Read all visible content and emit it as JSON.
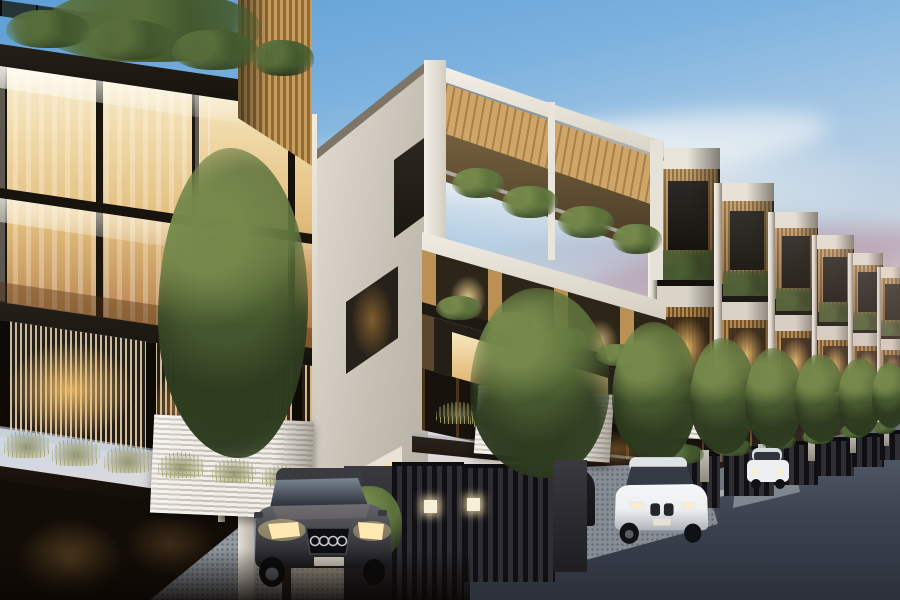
{
  "scene": {
    "type": "architectural-rendering",
    "description": "Dusk exterior rendering of a terrace of modern four-storey townhouses: a dark timber-and-glass corner residence on the left with warm lit interiors, a white townhouse with rooftop pergola in the centre, and identical units receding down the street to the right; gated driveways with parked cars, ornamental trees and balcony planting front a dark asphalt road under a blue-to-sunset sky",
    "time_of_day": "dusk",
    "colors": {
      "sky_top_blue": "#5e9ed4",
      "sky_mid_blue": "#a9c9e4",
      "sky_pale": "#ded9dc",
      "sky_warm": "#ecd7c6",
      "sunset_orange": "#ef8a3c",
      "cloud_mauve": "#a77f92",
      "facade_dark": "#1c1712",
      "facade_white": "#e9e4da",
      "facade_white_shade": "#c9c2b8",
      "wood_warm": "#c49a5e",
      "wood_deep": "#9c7437",
      "window_glow_bright": "#f7ecd2",
      "window_glow_amber": "#e9c27c",
      "window_glow_deep": "#c08b46",
      "glass_cool": "#9fb2bd",
      "foliage_dark": "#2c3a20",
      "foliage_mid": "#4c5e31",
      "foliage_light": "#6d7f44",
      "road_dark": "#303641",
      "road_mid": "#49515e",
      "curb_light": "#9aa0a6",
      "driveway_concrete": "#8d939b",
      "planter_white": "#efece6",
      "car_dark_body": "#44444a",
      "car_white_body": "#edeff1",
      "headlight_warm": "#ffe9b0"
    },
    "row_units": [
      {
        "x": 648,
        "top": 148,
        "w": 72,
        "bottom": 502
      },
      {
        "x": 714,
        "top": 183,
        "w": 60,
        "bottom": 488
      },
      {
        "x": 768,
        "top": 212,
        "w": 50,
        "bottom": 477
      },
      {
        "x": 812,
        "top": 235,
        "w": 42,
        "bottom": 468
      },
      {
        "x": 848,
        "top": 253,
        "w": 35,
        "bottom": 459
      },
      {
        "x": 877,
        "top": 267,
        "w": 28,
        "bottom": 452
      }
    ],
    "trees": [
      {
        "x": 158,
        "y": 148,
        "w": 150,
        "h": 310,
        "trunk": {
          "x": 218,
          "y1": 300,
          "y2": 522,
          "w": 7,
          "light": true
        }
      },
      {
        "x": 470,
        "y": 288,
        "w": 140,
        "h": 190,
        "trunk": {
          "x": 534,
          "y1": 388,
          "y2": 470,
          "w": 5,
          "light": true
        }
      },
      {
        "x": 612,
        "y": 322,
        "w": 86,
        "h": 140,
        "trunk": {
          "x": 652,
          "y1": 420,
          "y2": 468,
          "w": 4
        }
      },
      {
        "x": 690,
        "y": 338,
        "w": 66,
        "h": 116,
        "trunk": {
          "x": 720,
          "y1": 420,
          "y2": 462,
          "w": 3
        }
      },
      {
        "x": 745,
        "y": 348,
        "w": 58,
        "h": 100,
        "trunk": {
          "x": 772,
          "y1": 420,
          "y2": 456,
          "w": 3
        }
      },
      {
        "x": 795,
        "y": 354,
        "w": 50,
        "h": 88,
        "trunk": {
          "x": 818,
          "y1": 418,
          "y2": 450,
          "w": 2
        }
      },
      {
        "x": 838,
        "y": 358,
        "w": 44,
        "h": 78,
        "trunk": {
          "x": 858,
          "y1": 416,
          "y2": 446,
          "w": 2
        }
      },
      {
        "x": 872,
        "y": 362,
        "w": 36,
        "h": 66,
        "trunk": {
          "x": 888,
          "y1": 414,
          "y2": 442,
          "w": 2
        }
      }
    ],
    "shrubs": [
      {
        "x": 40,
        "y": -10,
        "w": 220,
        "h": 72,
        "tone": "dark"
      },
      {
        "x": 6,
        "y": 10,
        "w": 84,
        "h": 38,
        "tone": "dark"
      },
      {
        "x": 86,
        "y": 20,
        "w": 90,
        "h": 40,
        "tone": "dark"
      },
      {
        "x": 172,
        "y": 30,
        "w": 86,
        "h": 40,
        "tone": "dark"
      },
      {
        "x": 252,
        "y": 40,
        "w": 62,
        "h": 36,
        "tone": "dark"
      },
      {
        "x": 452,
        "y": 168,
        "w": 52,
        "h": 30,
        "tone": "mid"
      },
      {
        "x": 502,
        "y": 186,
        "w": 56,
        "h": 32,
        "tone": "mid"
      },
      {
        "x": 558,
        "y": 206,
        "w": 56,
        "h": 32,
        "tone": "mid"
      },
      {
        "x": 612,
        "y": 224,
        "w": 50,
        "h": 30,
        "tone": "mid"
      },
      {
        "x": 436,
        "y": 296,
        "w": 46,
        "h": 24,
        "tone": "mid"
      },
      {
        "x": 488,
        "y": 312,
        "w": 48,
        "h": 24,
        "tone": "mid"
      },
      {
        "x": 542,
        "y": 328,
        "w": 48,
        "h": 24,
        "tone": "mid"
      },
      {
        "x": 596,
        "y": 344,
        "w": 44,
        "h": 22,
        "tone": "mid"
      },
      {
        "x": 660,
        "y": 444,
        "w": 44,
        "h": 20,
        "tone": "dark"
      },
      {
        "x": 712,
        "y": 438,
        "w": 40,
        "h": 18,
        "tone": "dark"
      },
      {
        "x": 760,
        "y": 433,
        "w": 36,
        "h": 16,
        "tone": "dark"
      },
      {
        "x": 802,
        "y": 429,
        "w": 32,
        "h": 15,
        "tone": "dark"
      },
      {
        "x": 840,
        "y": 425,
        "w": 28,
        "h": 13,
        "tone": "dark"
      },
      {
        "x": 872,
        "y": 422,
        "w": 24,
        "h": 12,
        "tone": "dark"
      },
      {
        "x": 338,
        "y": 486,
        "w": 64,
        "h": 74,
        "tone": "mid"
      },
      {
        "x": 4,
        "y": 430,
        "w": 46,
        "h": 28,
        "tone": "grass"
      },
      {
        "x": 52,
        "y": 438,
        "w": 48,
        "h": 28,
        "tone": "grass"
      },
      {
        "x": 104,
        "y": 445,
        "w": 48,
        "h": 28,
        "tone": "grass"
      },
      {
        "x": 158,
        "y": 452,
        "w": 46,
        "h": 26,
        "tone": "grass"
      },
      {
        "x": 212,
        "y": 459,
        "w": 44,
        "h": 24,
        "tone": "grass"
      },
      {
        "x": 262,
        "y": 465,
        "w": 40,
        "h": 22,
        "tone": "grass"
      },
      {
        "x": 436,
        "y": 402,
        "w": 44,
        "h": 22,
        "tone": "grass"
      },
      {
        "x": 470,
        "y": 408,
        "w": 40,
        "h": 20,
        "tone": "grass"
      }
    ],
    "planters": [
      {
        "x": 152,
        "y": 418,
        "w": 160,
        "h": 98,
        "rot": 2.5
      },
      {
        "x": 476,
        "y": 390,
        "w": 136,
        "h": 68,
        "rot": 4
      },
      {
        "x": 648,
        "y": 404,
        "w": 70,
        "h": 34,
        "rot": 4
      },
      {
        "x": 712,
        "y": 400,
        "w": 58,
        "h": 28,
        "rot": 4
      },
      {
        "x": 766,
        "y": 396,
        "w": 50,
        "h": 24,
        "rot": 4
      },
      {
        "x": 812,
        "y": 392,
        "w": 42,
        "h": 20,
        "rot": 4
      },
      {
        "x": 850,
        "y": 389,
        "w": 36,
        "h": 17,
        "rot": 4
      },
      {
        "x": 879,
        "y": 387,
        "w": 30,
        "h": 15,
        "rot": 4
      }
    ],
    "gates": [
      {
        "x": 344,
        "y": 466,
        "w": 50,
        "h": 134,
        "kind": "pillar"
      },
      {
        "x": 392,
        "y": 462,
        "w": 72,
        "h": 138,
        "kind": "bars",
        "light": [
          32,
          34
        ]
      },
      {
        "x": 463,
        "y": 464,
        "w": 92,
        "h": 114,
        "kind": "bars",
        "light": [
          4,
          30
        ]
      },
      {
        "x": 553,
        "y": 460,
        "w": 34,
        "h": 112,
        "kind": "pillar",
        "z": 34
      },
      {
        "x": 662,
        "y": 452,
        "w": 58,
        "h": 52,
        "kind": "bars"
      },
      {
        "x": 724,
        "y": 446,
        "w": 50,
        "h": 46,
        "kind": "bars"
      },
      {
        "x": 774,
        "y": 441,
        "w": 44,
        "h": 40,
        "kind": "bars"
      },
      {
        "x": 816,
        "y": 437,
        "w": 38,
        "h": 35,
        "kind": "bars"
      },
      {
        "x": 852,
        "y": 433,
        "w": 32,
        "h": 30,
        "kind": "bars"
      },
      {
        "x": 880,
        "y": 430,
        "w": 26,
        "h": 26,
        "kind": "bars"
      }
    ],
    "bollards": [
      {
        "x": 700,
        "y": 450,
        "w": 9,
        "h": 32
      },
      {
        "x": 758,
        "y": 444,
        "w": 8,
        "h": 27
      },
      {
        "x": 808,
        "y": 438,
        "w": 7,
        "h": 23
      },
      {
        "x": 850,
        "y": 434,
        "w": 6,
        "h": 19
      },
      {
        "x": 884,
        "y": 430,
        "w": 5,
        "h": 16
      }
    ],
    "cars": [
      {
        "kind": "suv-dark",
        "x": 246,
        "y": 462,
        "w": 150,
        "h": 138
      },
      {
        "kind": "crossover-white",
        "x": 608,
        "y": 452,
        "w": 106,
        "h": 95
      },
      {
        "kind": "car-white-far",
        "x": 744,
        "y": 446,
        "w": 48,
        "h": 44
      }
    ]
  }
}
